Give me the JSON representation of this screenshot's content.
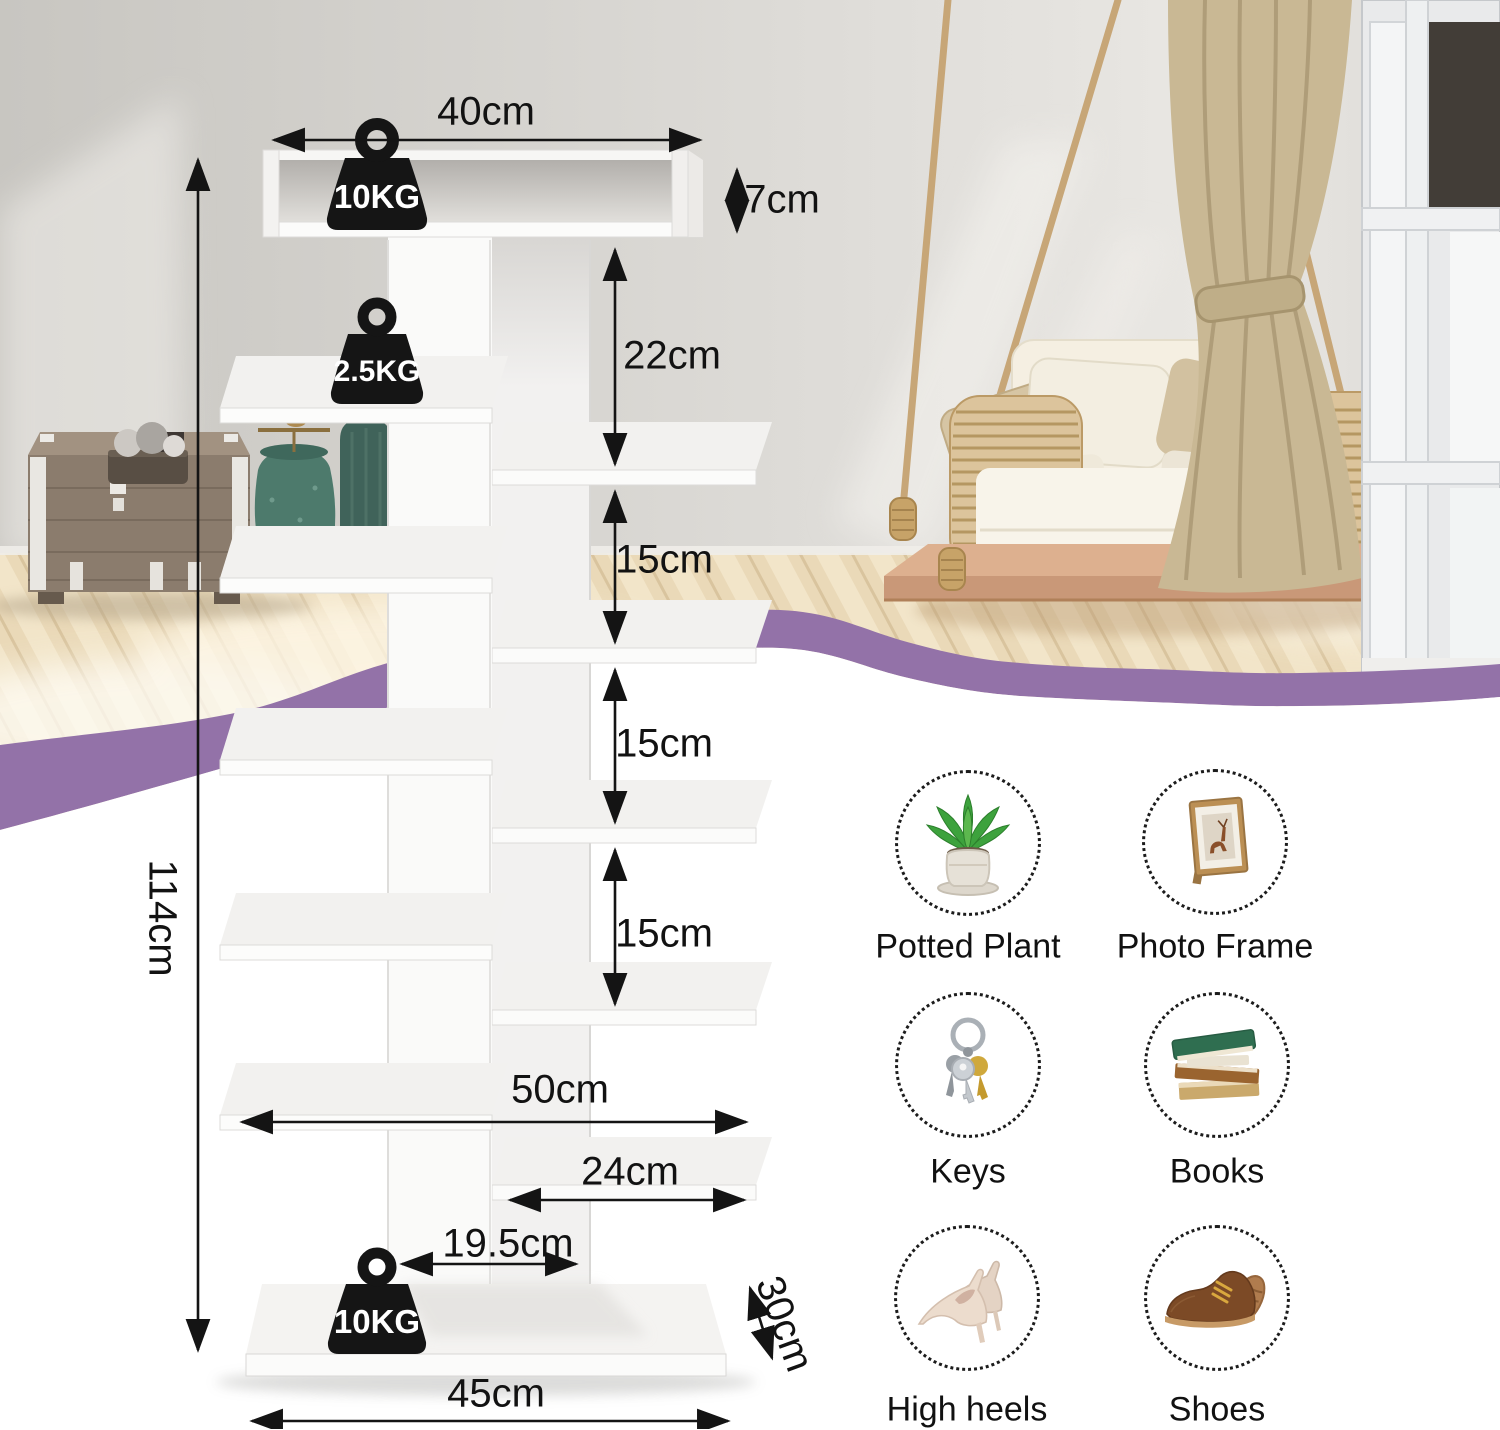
{
  "page": {
    "type": "shoe-rack-dimension-diagram"
  },
  "diagram": {
    "weights": {
      "top_shelf": "10KG",
      "side_shelf": "2.5KG",
      "base": "10KG"
    },
    "dimensions": {
      "top_shelf_width": "40cm",
      "top_shelf_height": "7cm",
      "top_gap": "22cm",
      "gap_1": "15cm",
      "gap_2": "15cm",
      "gap_3": "15cm",
      "total_height": "114cm",
      "left_shelf_span": "50cm",
      "right_shelf_width": "24cm",
      "base_clearance": "19.5cm",
      "depth": "30cm",
      "base_width": "45cm"
    }
  },
  "storage_items": [
    {
      "label": "Potted Plant",
      "icon": "potted-plant"
    },
    {
      "label": "Photo Frame",
      "icon": "photo-frame"
    },
    {
      "label": "Keys",
      "icon": "keys"
    },
    {
      "label": "Books",
      "icon": "books"
    },
    {
      "label": "High heels",
      "icon": "high-heels"
    },
    {
      "label": "Shoes",
      "icon": "shoes"
    }
  ],
  "colors": {
    "accent_wave": "#9372a8",
    "shelf_white": "#fbfbfa",
    "wall": "#cbc8c3",
    "floor": "#ead9b8",
    "annotation": "#141414"
  }
}
